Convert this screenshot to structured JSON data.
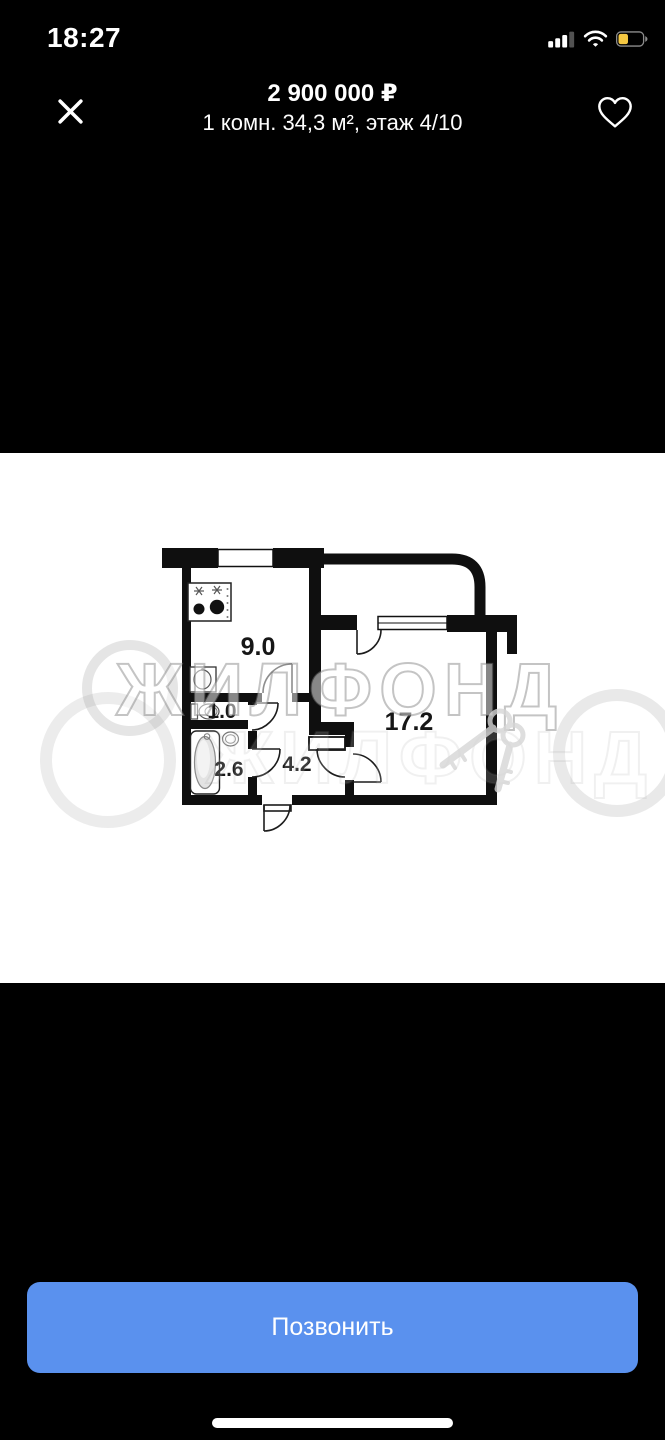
{
  "status_bar": {
    "time": "18:27",
    "signal": {
      "bars_total": 4,
      "bars_filled": 3
    },
    "wifi": "on",
    "battery": {
      "level_fraction": 0.35,
      "low_power": true
    }
  },
  "header": {
    "price": "2 900 000 ₽",
    "subtitle": "1 комн. 34,3 м², этаж 4/10"
  },
  "photo": {
    "type": "floor-plan",
    "watermark": "ЖИЛФОНД",
    "rooms": [
      {
        "name": "kitchen",
        "area_label": "9.0"
      },
      {
        "name": "toilet",
        "area_label": "1.0"
      },
      {
        "name": "bathroom",
        "area_label": "2.6"
      },
      {
        "name": "hallway",
        "area_label": "4.2"
      },
      {
        "name": "living-room",
        "area_label": "17.2"
      }
    ]
  },
  "actions": {
    "call_label": "Позвонить"
  },
  "colors": {
    "accent_blue": "#5a91ee",
    "battery_yellow": "#f5c842",
    "page_bg": "#000000",
    "photo_bg": "#ffffff"
  }
}
